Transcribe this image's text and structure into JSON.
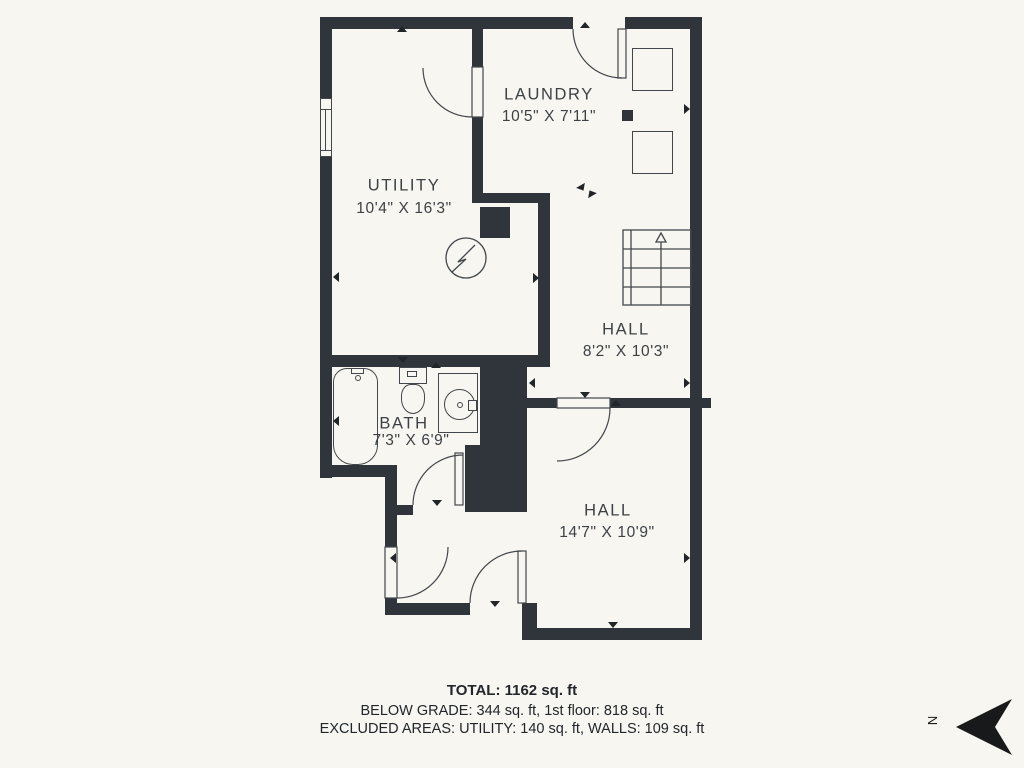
{
  "plan": {
    "rooms": [
      {
        "name": "LAUNDRY",
        "dims": "10'5\" X 7'11\""
      },
      {
        "name": "UTILITY",
        "dims": "10'4\" X 16'3\""
      },
      {
        "name": "HALL",
        "dims": "8'2\" X 10'3\""
      },
      {
        "name": "BATH",
        "dims": "7'3\" X 6'9\""
      },
      {
        "name": "HALL",
        "dims": "14'7\" X 10'9\""
      }
    ]
  },
  "footer": {
    "total": "TOTAL: 1162 sq. ft",
    "below_grade": "BELOW GRADE: 344 sq. ft, 1st floor: 818 sq. ft",
    "excluded": "EXCLUDED AREAS: UTILITY: 140 sq. ft, WALLS: 109 sq. ft"
  },
  "compass": {
    "label": "N",
    "direction": "pointing-left"
  },
  "icons": {
    "north_arrow": "black dart polygon pointing left",
    "stairs_arrow": "open triangle pointing up",
    "electric_meter": "circle with lightning bolt",
    "electrical_panel": "filled dark square",
    "wall_marker": "small filled triangle on wall face"
  },
  "colors": {
    "background": "#f7f6f0",
    "wall": "#2f353a",
    "line": "#42474d",
    "room_text": "#3c4147",
    "footer_text": "#21262c"
  }
}
